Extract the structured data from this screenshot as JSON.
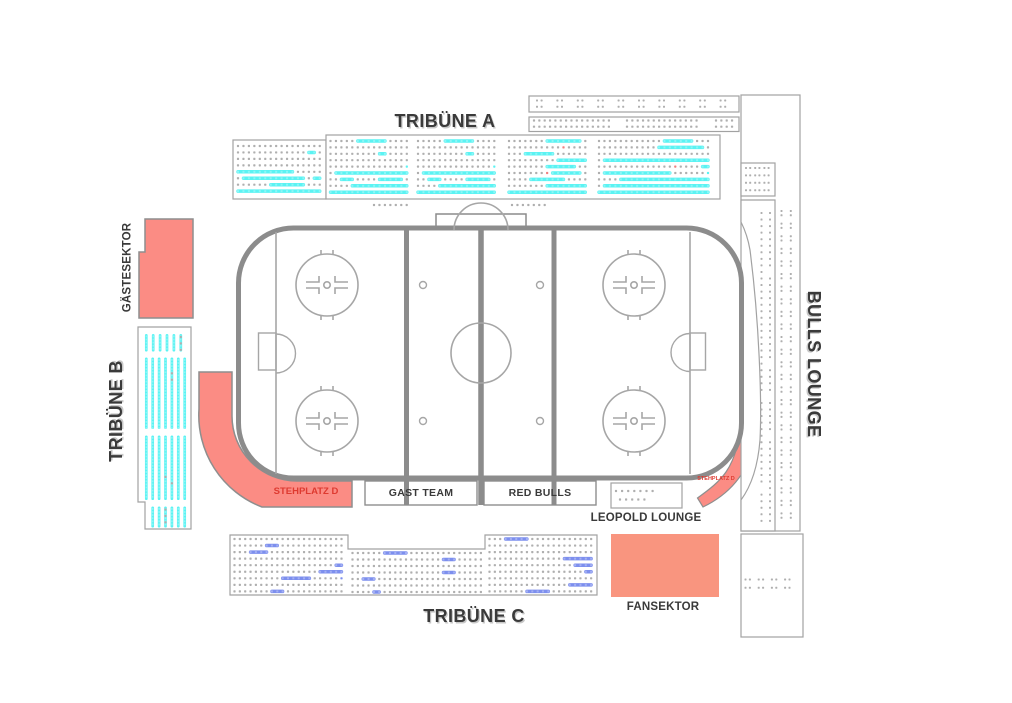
{
  "labels": {
    "tribune_a": "TRIBÜNE A",
    "tribune_b": "TRIBÜNE B",
    "tribune_c": "TRIBÜNE C",
    "bulls_lounge": "BULLS LOUNGE",
    "gaestesektor": "GÄSTESEKTOR",
    "stehplatz_d_left": "STEHPLATZ D",
    "stehplatz_d_right": "STEHPLATZ D",
    "leopold_lounge": "LEOPOLD LOUNGE",
    "fansektor": "FANSEKTOR",
    "gast_team": "GAST TEAM",
    "red_bulls": "RED BULLS"
  },
  "colors": {
    "seat_cyan": "#5BF3F3",
    "seat_blue": "#7D8FEE",
    "seat_taken": "#AFAFAF",
    "seat_red": "#F08080",
    "standing_fill": "#FB8C84",
    "fansektor_fill": "#F9957F",
    "outline": "#8E8E8E",
    "rink_line": "#8C8C8C",
    "rink_thin": "#A6A6A6",
    "box_border": "#A2A2A2",
    "label_color": "#3A3A3A",
    "stehplatz_label_color": "#DE3A30"
  },
  "seat_blocks": [
    {
      "name": "tribune-a-left",
      "type": "rows",
      "x": 238,
      "y": 146,
      "cols": 16,
      "rows": 8,
      "px": 5.45,
      "py": 6.45,
      "accent": "seat_cyan",
      "p0": 0.02,
      "p1": 0.33,
      "run_min": 3,
      "run_max": 22,
      "ramp": true,
      "full_bottom": 1,
      "red_prob": 0.004,
      "seed": 11
    },
    {
      "name": "tribune-a-1",
      "type": "rows",
      "x": 330.5,
      "y": 141,
      "cols": 15,
      "rows": 9,
      "px": 5.45,
      "py": 6.4,
      "accent": "seat_cyan",
      "p0": 0.02,
      "p1": 0.33,
      "run_min": 3,
      "run_max": 22,
      "ramp": true,
      "full_bottom": 1,
      "red_prob": 0.004,
      "seed": 12
    },
    {
      "name": "tribune-a-2",
      "type": "rows",
      "x": 418,
      "y": 141,
      "cols": 15,
      "rows": 9,
      "px": 5.45,
      "py": 6.4,
      "accent": "seat_cyan",
      "p0": 0.02,
      "p1": 0.33,
      "run_min": 3,
      "run_max": 22,
      "ramp": true,
      "full_bottom": 1,
      "red_prob": 0.004,
      "seed": 12
    },
    {
      "name": "tribune-a-3",
      "type": "rows",
      "x": 509,
      "y": 141,
      "cols": 15,
      "rows": 9,
      "px": 5.45,
      "py": 6.4,
      "accent": "seat_cyan",
      "p0": 0.02,
      "p1": 0.33,
      "run_min": 3,
      "run_max": 22,
      "ramp": true,
      "full_bottom": 1,
      "red_prob": 0.004,
      "seed": 14
    },
    {
      "name": "tribune-a-4",
      "type": "rows",
      "x": 599,
      "y": 141,
      "cols": 21,
      "rows": 9,
      "px": 5.45,
      "py": 6.4,
      "accent": "seat_cyan",
      "p0": 0.03,
      "p1": 0.4,
      "run_min": 4,
      "run_max": 24,
      "ramp": true,
      "full_bottom": 1,
      "red_prob": 0.004,
      "seed": 15
    },
    {
      "name": "tribune-a-extra-1",
      "type": "dotgrid",
      "x": 374,
      "y": 205,
      "cols": 7,
      "rows": 1,
      "px": 5.45,
      "py": 6
    },
    {
      "name": "tribune-a-extra-2",
      "type": "dotgrid",
      "x": 512,
      "y": 205,
      "cols": 7,
      "rows": 1,
      "px": 5.45,
      "py": 6
    },
    {
      "name": "top-strip-upper",
      "type": "clusters",
      "x": 537,
      "y": 100.5,
      "ncl": 10,
      "cl_pitch": 20.4,
      "cols_per": 2,
      "col_pitch": 4.6,
      "rows": 2,
      "row_pitch": 6.2
    },
    {
      "name": "top-strip-lower-1",
      "type": "dotgrid",
      "x": 534,
      "y": 120.5,
      "cols": 15,
      "rows": 2,
      "px": 5.35,
      "py": 6.2
    },
    {
      "name": "top-strip-lower-2",
      "type": "dotgrid",
      "x": 627,
      "y": 120.5,
      "cols": 14,
      "rows": 2,
      "px": 5.35,
      "py": 6.2
    },
    {
      "name": "top-strip-lower-3",
      "type": "dotgrid",
      "x": 716,
      "y": 120.5,
      "cols": 4,
      "rows": 2,
      "px": 5.35,
      "py": 6.2
    },
    {
      "name": "bulls-small-box-dots",
      "type": "clusters",
      "x": 746,
      "y": 168,
      "ncl": 3,
      "cl_pitch": 9.2,
      "cols_per": 2,
      "col_pitch": 4.2,
      "rows": 4,
      "row_pitch": 7.4
    },
    {
      "name": "bulls-strip-dots",
      "type": "vcol",
      "x": 761.5,
      "y": 213,
      "y2": 527,
      "py": 6.55,
      "cols": [
        0,
        8.5
      ],
      "gap_prob": 0.06,
      "seed": 21
    },
    {
      "name": "bulls-outer-dots",
      "type": "vclu",
      "x": 781.5,
      "y": 211,
      "y2": 521,
      "pitch": 12.6,
      "sub": [
        0,
        4.3
      ],
      "cols": [
        0,
        9.3
      ]
    },
    {
      "name": "bulls-bottom-dots",
      "type": "clusters",
      "x": 745.5,
      "y": 579.5,
      "ncl": 4,
      "cl_pitch": 13.2,
      "cols_per": 2,
      "col_pitch": 4.4,
      "rows": 2,
      "row_pitch": 8.2
    },
    {
      "name": "leopold-row-1",
      "type": "dotgrid",
      "x": 616,
      "y": 491,
      "cols": 7,
      "rows": 1,
      "px": 6.1,
      "py": 6
    },
    {
      "name": "leopold-row-2",
      "type": "dotgrid",
      "x": 620,
      "y": 499.5,
      "cols": 5,
      "rows": 1,
      "px": 6.1,
      "py": 6
    },
    {
      "name": "tribune-b-1",
      "type": "vbars",
      "x": 146.3,
      "y": 334,
      "y2": 351.5,
      "cols": 6,
      "px": 6.9,
      "dot_prob": 0.5,
      "seed": 41
    },
    {
      "name": "tribune-b-2",
      "type": "vbars",
      "x": 146.3,
      "y": 357.5,
      "y2": 429,
      "cols": 7,
      "px": 6.4,
      "dot_prob": 0.4,
      "seed": 42
    },
    {
      "name": "tribune-b-3",
      "type": "vbars",
      "x": 146.3,
      "y": 435.5,
      "y2": 500,
      "cols": 7,
      "px": 6.4,
      "dot_prob": 0.18,
      "seed": 43
    },
    {
      "name": "tribune-b-4",
      "type": "vbars",
      "x": 152.7,
      "y": 506.5,
      "y2": 527.5,
      "cols": 6,
      "px": 6.4,
      "dot_prob": 0.1,
      "seed": 44
    },
    {
      "name": "tribune-c-left",
      "type": "rows",
      "x": 234.5,
      "y": 539,
      "cols": 21,
      "rows": 9,
      "px": 5.35,
      "py": 6.55,
      "accent": "seat_blue",
      "p0": 0.045,
      "p1": 0,
      "run_min": 2,
      "run_max": 8,
      "ramp": false,
      "full_bottom": 0,
      "red_prob": 0,
      "seed": 31
    },
    {
      "name": "tribune-c-mid",
      "type": "rows",
      "x": 352.5,
      "y": 553,
      "cols": 25,
      "rows": 7,
      "px": 5.35,
      "py": 6.5,
      "accent": "seat_blue",
      "p0": 0.045,
      "p1": 0,
      "run_min": 2,
      "run_max": 8,
      "ramp": false,
      "full_bottom": 0,
      "red_prob": 0,
      "seed": 32
    },
    {
      "name": "tribune-c-right",
      "type": "rows",
      "x": 489.5,
      "y": 539,
      "cols": 20,
      "rows": 9,
      "px": 5.35,
      "py": 6.55,
      "accent": "seat_blue",
      "p0": 0.045,
      "p1": 0,
      "run_min": 2,
      "run_max": 8,
      "ramp": false,
      "full_bottom": 0,
      "red_prob": 0,
      "seed": 33
    }
  ]
}
